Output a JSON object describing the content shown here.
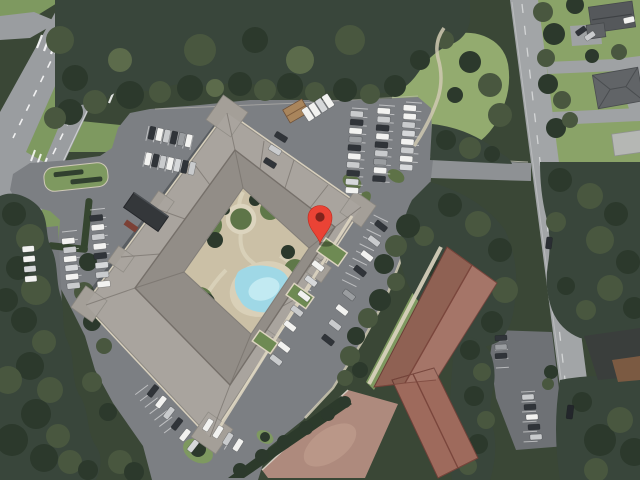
{
  "scene": {
    "type": "satellite-aerial-view",
    "description": "Aerial satellite view of a large apartment complex with central courtyard and swimming pool, ring parking lots with cars, a divided highway at upper left, a two-lane road on the right with houses, woods surrounding, an L-shaped annex building at lower right, and a red map pin marker on the complex"
  },
  "marker": {
    "icon": "map-pin-icon",
    "color": "#EA4335",
    "dot_color": "#7F231C",
    "x": 320,
    "y": 243
  },
  "palette": {
    "tree_base": "#3A4736",
    "tree_dark": "#2C392C",
    "tree_mid": "#49573F",
    "lawn": "#7E9960",
    "lawn_light": "#93AB6F",
    "highway": "#9A9DA0",
    "road": "#A2A5A7",
    "asphalt": "#7C7F83",
    "drive": "#8E9194",
    "roof": "#A49F98",
    "roof_ridge": "#6E6963",
    "sidewalk": "#DCD4C0",
    "courtyard": "#CBC0A6",
    "pool": "#9FD8E6",
    "pool_light": "#C2EAF2",
    "annex_roof": "#9E6A5C",
    "annex_ridge": "#7A463C",
    "court_pink": "#AE8A7D",
    "house_roof": "#5A5D60",
    "carport": "#34373A",
    "hut_roof": "#A9855C",
    "marking": "#FFFFFF"
  },
  "cars": {
    "colors": [
      "#F2F2F0",
      "#C9CBCD",
      "#303439",
      "#9A9DA0",
      "#4A5568",
      "#8A4A3E",
      "#D6D8DA"
    ]
  }
}
